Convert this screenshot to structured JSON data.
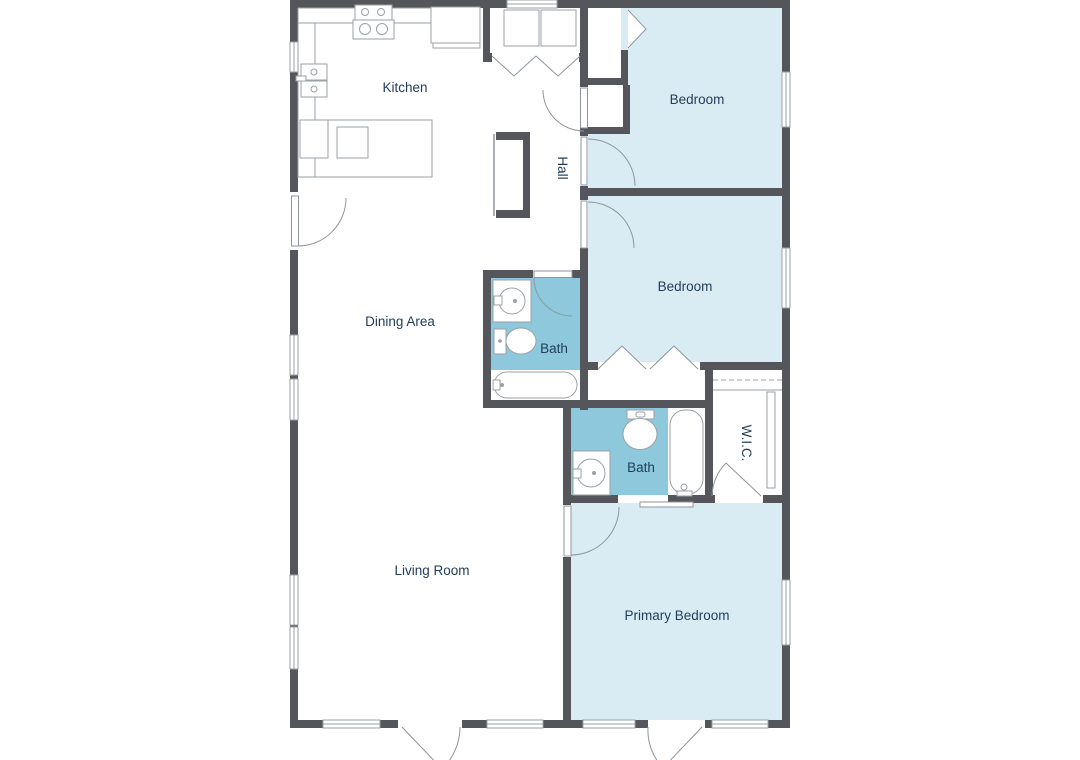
{
  "title": "Floor Plan",
  "colors": {
    "wall": "#54565b",
    "room_fill": "#d9ecf3",
    "bath_fill": "#8dc8dc",
    "label": "#1f3c58",
    "fixture_line": "#9aa1a7",
    "door_line": "#8e969c",
    "background": "#ffffff"
  },
  "rooms": {
    "kitchen": {
      "label": "Kitchen"
    },
    "hall": {
      "label": "Hall"
    },
    "bedroom_top": {
      "label": "Bedroom"
    },
    "bedroom_middle": {
      "label": "Bedroom"
    },
    "dining": {
      "label": "Dining Area"
    },
    "bath_hall": {
      "label": "Bath"
    },
    "bath_primary": {
      "label": "Bath"
    },
    "wic": {
      "label": "W.I.C."
    },
    "living": {
      "label": "Living Room"
    },
    "primary": {
      "label": "Primary Bedroom"
    }
  }
}
